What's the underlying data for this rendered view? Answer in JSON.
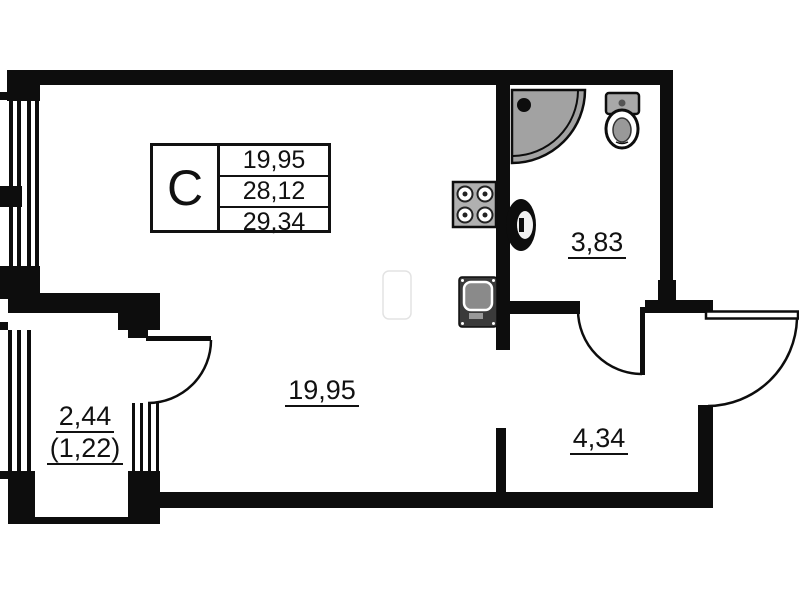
{
  "plan": {
    "legend": {
      "type_label": "С",
      "area_rows": [
        "19,95",
        "28,12",
        "29,34"
      ]
    },
    "rooms": {
      "main_area": "19,95",
      "bathroom_area": "3,83",
      "hallway_area": "4,34",
      "balcony_area": "2,44",
      "balcony_reduced_area": "(1,22)"
    },
    "colors": {
      "wall": "#0d0d0d",
      "background": "#ffffff",
      "fixture_gray": "#a2a2a2"
    }
  }
}
